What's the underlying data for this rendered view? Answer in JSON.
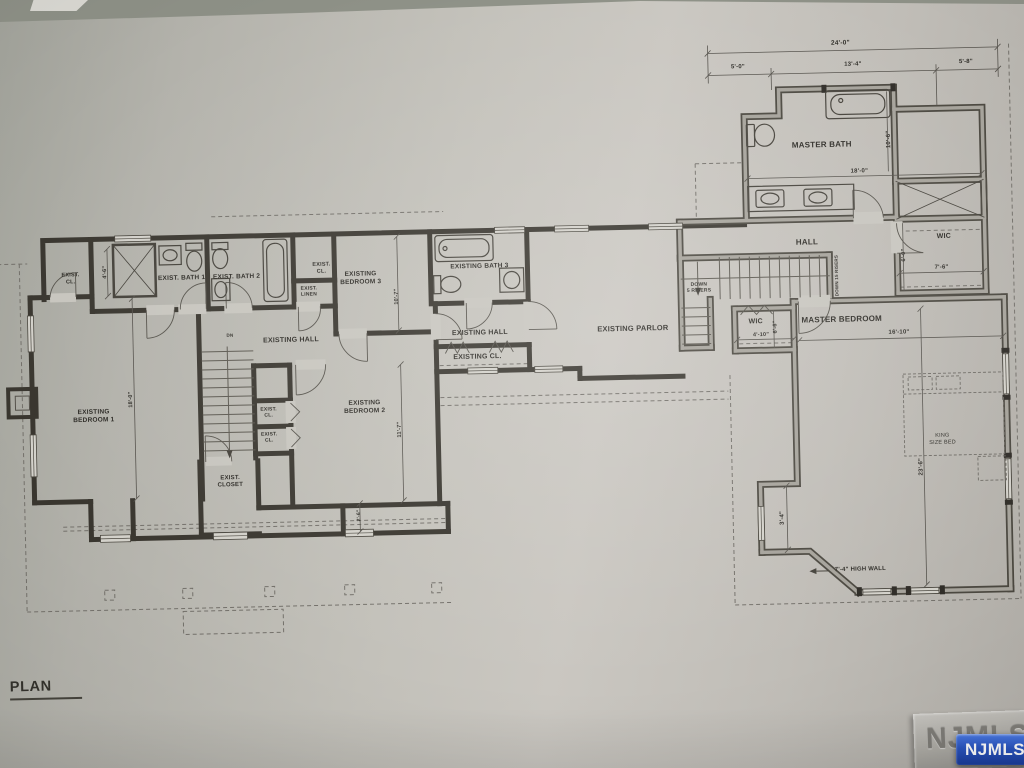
{
  "sheet": {
    "title_fragment": "PLAN"
  },
  "watermark": {
    "label": "NJMLS",
    "badge_color": "#2a55c0"
  },
  "rooms": {
    "master_bath": "MASTER BATH",
    "hall": "HALL",
    "wic_right": "WIC",
    "wic_left": "WIC",
    "master_bedroom": "MASTER BEDROOM",
    "existing_parlor": "EXISTING PARLOR",
    "existing_hall_upper": "EXISTING HALL",
    "existing_hall_lower": "EXISTING HALL",
    "existing_cl": "EXISTING CL.",
    "existing_bedroom_1": "EXISTING\nBEDROOM 1",
    "existing_bedroom_2": "EXISTING\nBEDROOM 2",
    "existing_bedroom_3": "EXISTING\nBEDROOM 3",
    "exist_bath_1": "EXIST. BATH 1",
    "exist_bath_2": "EXIST. BATH 2",
    "existing_bath_3": "EXISTING BATH 3",
    "exist_cl_nw": "EXIST.\nCL.",
    "exist_cl_mid": "EXIST.\nCL.",
    "exist_linen": "EXIST.\nLINEN",
    "exist_cl_a": "EXIST.\nCL.",
    "exist_cl_b": "EXIST.\nCL.",
    "exist_closet": "EXIST.\nCLOSET",
    "king_bed": "KING\nSIZE BED"
  },
  "dimensions": {
    "overall": "24'-0\"",
    "seg_left": "5'-0\"",
    "seg_mid": "13'-4\"",
    "seg_right": "5'-8\"",
    "bath_width": "18'-0\"",
    "bath_depth": "10'-6\"",
    "wic_right_w": "7'-6\"",
    "wic_right_d": "6'-0\"",
    "wic_left_w": "4'-10\"",
    "wic_left_d": "6'-6\"",
    "master_w": "16'-10\"",
    "master_d": "23'-6\"",
    "jog": "3'-4\"",
    "cl_nw": "4'-6\"",
    "bedroom1_d": "18'-0\"",
    "bedroom2_d": "11'-7\"",
    "bedroom3_d": "10'-7\"",
    "bay": "2'-6\""
  },
  "notes": {
    "high_wall": "7'-4\" HIGH WALL",
    "down5": "DOWN\n5 RISERS",
    "down15": "DOWN 15 RISERS",
    "dn": "DN"
  }
}
